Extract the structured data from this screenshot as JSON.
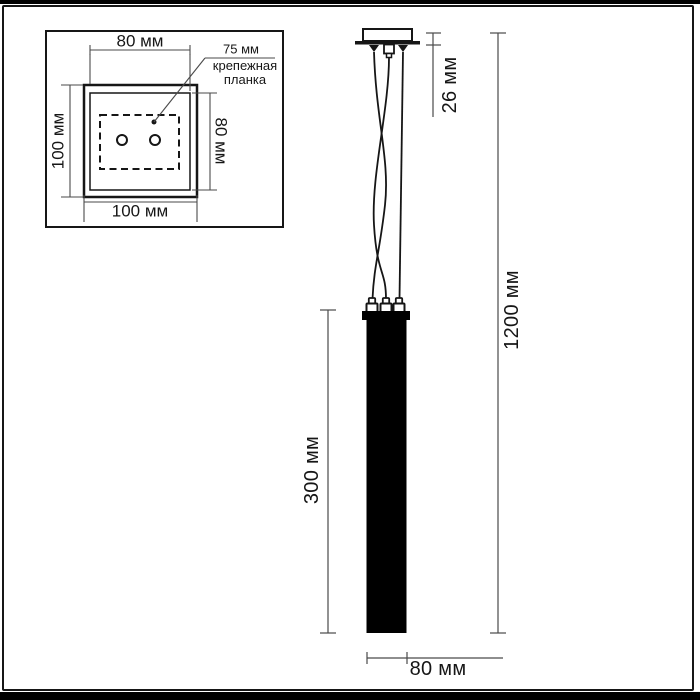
{
  "inset": {
    "top_width_label": "80 мм",
    "left_height_label": "100 мм",
    "right_inner_height_label": "80 мм",
    "bottom_width_label": "100 мм",
    "callout": {
      "value": "75 мм",
      "name_line1": "крепежная",
      "name_line2": "планка"
    }
  },
  "main_view": {
    "canopy_height_label": "26 мм",
    "overall_height_label": "1200 мм",
    "shade_height_label": "300 мм",
    "shade_width_label": "80 мм"
  },
  "colors": {
    "ink": "#161616",
    "dimension_line": "#4a4a4a",
    "shade_fill": "#000000",
    "background": "#ffffff"
  }
}
